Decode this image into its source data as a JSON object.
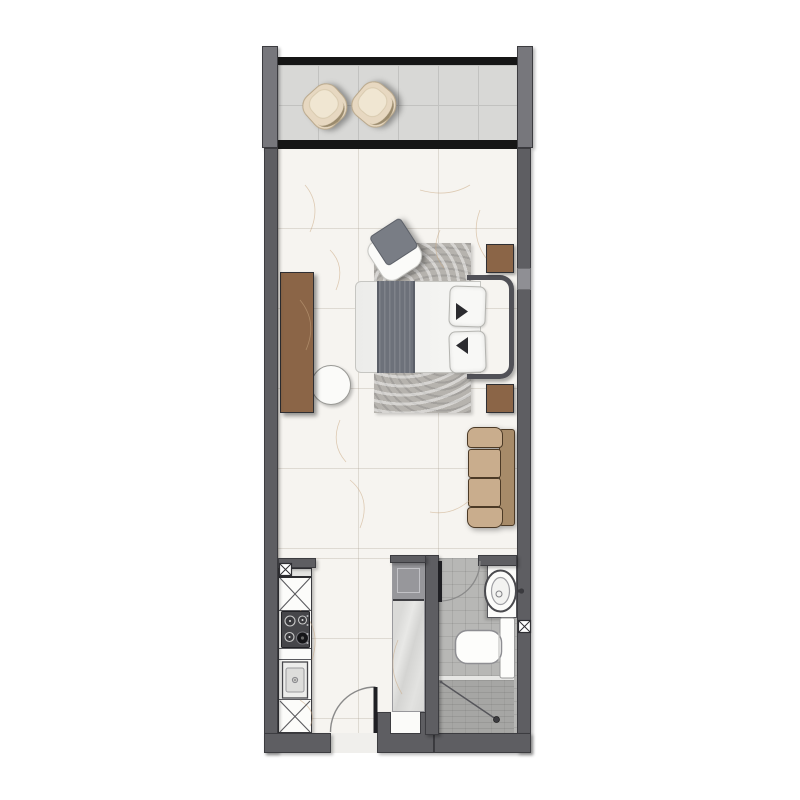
{
  "document": {
    "type": "floor-plan",
    "visible_text": []
  },
  "palette": {
    "wall": "#5e5e62",
    "wall-dark": "#3c3c40",
    "wall-light": "#8f8f94",
    "column": "#77777c",
    "black-line": "#161616",
    "balcony-floor": "#d8d8d6",
    "balcony-grid": "#c2c2c0",
    "marble": "#f6f4f0",
    "vein": "#c9a882",
    "bath-floor": "#b7b7b5",
    "shower": "#a6a6a4",
    "fixture": "#fbfbfb",
    "wood": "#8b6547",
    "rug": "#b6b3ae",
    "runner": "#6d717a",
    "headboard": "#515157",
    "sofa": "#c9ad8d",
    "sofa-back": "#a78b69",
    "sofa-dark": "#4c3a26",
    "chair-beige": "#e7d8c1",
    "chair-beige-dark": "#b9a88b",
    "washer": "#97979b",
    "stove": "#46464a"
  },
  "plan": {
    "rooms": [
      {
        "id": "balcony",
        "items": [
          "lounge-chair",
          "lounge-chair"
        ]
      },
      {
        "id": "bedroom-living",
        "items": [
          "double-bed",
          "headboard",
          "area-rug",
          "accent-chair",
          "nightstand",
          "nightstand",
          "desk",
          "desk-chair",
          "sofa"
        ]
      },
      {
        "id": "kitchen",
        "items": [
          "cabinet-x",
          "gas-stove-4-burner",
          "counter",
          "sink",
          "cabinet-x",
          "service-shaft"
        ]
      },
      {
        "id": "closet",
        "items": [
          "washing-machine",
          "wardrobe"
        ]
      },
      {
        "id": "bathroom",
        "items": [
          "washbasin-vanity",
          "toilet",
          "shower",
          "service-shaft"
        ]
      },
      {
        "id": "entry",
        "items": [
          "entry-door"
        ]
      }
    ],
    "openings": {
      "doors": [
        "entry-door",
        "bathroom-door"
      ],
      "windows": [
        "balcony-sliding-window",
        "side-window"
      ]
    }
  }
}
